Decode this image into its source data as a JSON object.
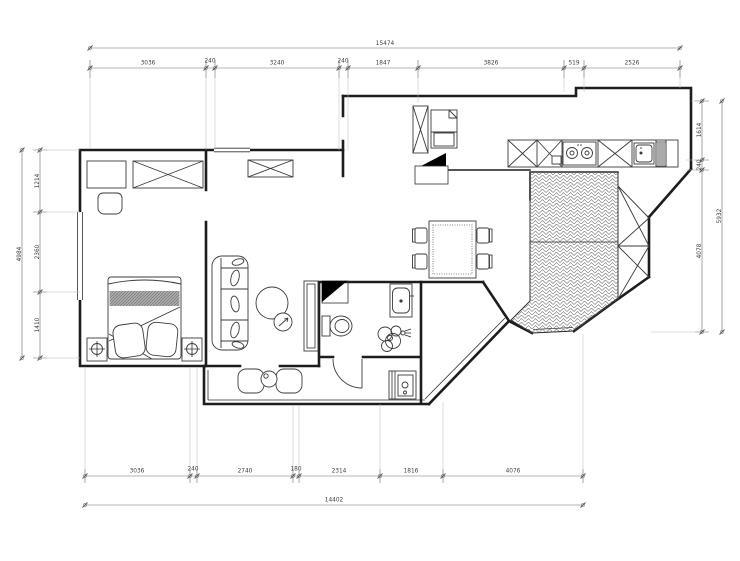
{
  "drawing": {
    "type": "apartment-floor-plan"
  },
  "colors": {
    "background": "#ffffff",
    "wall_line": "#1d1d1d",
    "furniture_line": "#3b3b3b",
    "dim_line": "#6a6a6a",
    "dim_text": "#3d3d3d",
    "black": "#000000",
    "mattress_gray": "#a9a9a9",
    "hatch_line": "#6f6f6f"
  },
  "dimensions": {
    "top": {
      "total": "15474",
      "segments": [
        "3036",
        "240",
        "3240",
        "240",
        "1847",
        "3826",
        "519",
        "2526"
      ]
    },
    "bottom": {
      "total": "14402",
      "segments": [
        "3036",
        "240",
        "2740",
        "180",
        "2314",
        "1816",
        "4076"
      ]
    },
    "left": {
      "total": "4984",
      "segments": [
        "1214",
        "2360",
        "1410"
      ]
    },
    "right": {
      "total": "5932",
      "segments": [
        "1614",
        "240",
        "4078"
      ]
    }
  }
}
